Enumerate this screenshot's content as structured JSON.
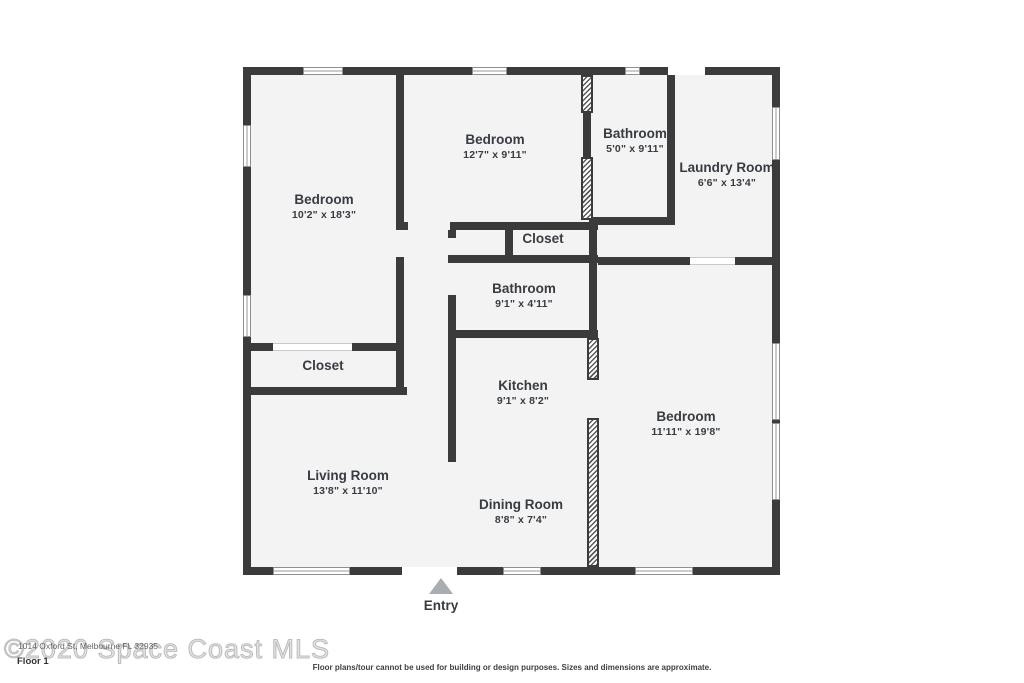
{
  "plan": {
    "rooms": [
      {
        "id": "bedroom-left",
        "name": "Bedroom",
        "dims": "10'2\" x 18'3\""
      },
      {
        "id": "bedroom-middle",
        "name": "Bedroom",
        "dims": "12'7\" x 9'11\""
      },
      {
        "id": "bathroom-top",
        "name": "Bathroom",
        "dims": "5'0\" x 9'11\""
      },
      {
        "id": "laundry-room",
        "name": "Laundry Room",
        "dims": "6'6\" x 13'4\""
      },
      {
        "id": "closet-middle",
        "name": "Closet",
        "dims": ""
      },
      {
        "id": "bathroom-middle",
        "name": "Bathroom",
        "dims": "9'1\" x 4'11\""
      },
      {
        "id": "closet-left",
        "name": "Closet",
        "dims": ""
      },
      {
        "id": "kitchen",
        "name": "Kitchen",
        "dims": "9'1\" x 8'2\""
      },
      {
        "id": "bedroom-right",
        "name": "Bedroom",
        "dims": "11'11\" x 19'8\""
      },
      {
        "id": "living-room",
        "name": "Living Room",
        "dims": "13'8\" x 11'10\""
      },
      {
        "id": "dining-room",
        "name": "Dining Room",
        "dims": "8'8\" x 7'4\""
      }
    ],
    "entry_label": "Entry"
  },
  "footer": {
    "watermark": "©2020 Space Coast MLS",
    "address": "1014 Oxford St, Melbourne FL 32935",
    "floor_label": "Floor 1",
    "disclaimer": "Floor plans/tour cannot be used for building or design purposes. Sizes and dimensions are approximate."
  },
  "colors": {
    "wall": "#3b3b3b",
    "room_fill": "#f4f3f3",
    "label_text": "#373c42",
    "entry_arrow": "#a9adb1",
    "watermark": "#bdbdbd"
  }
}
